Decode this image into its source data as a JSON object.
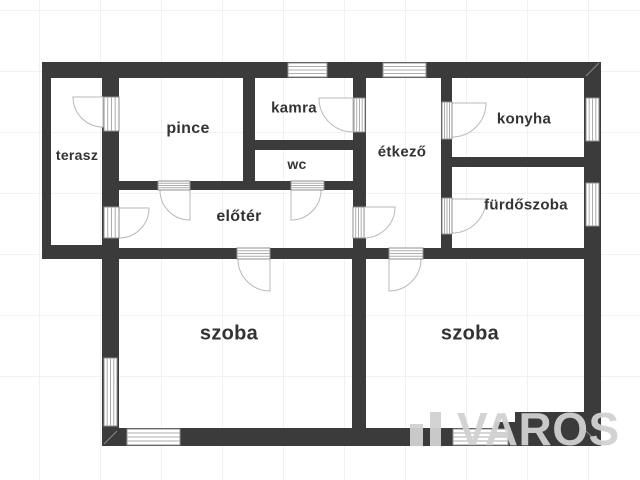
{
  "floor_plan": {
    "title": "floor plan of a house",
    "rooms": [
      {
        "id": "terasz",
        "label": "terasz"
      },
      {
        "id": "pince",
        "label": "pince"
      },
      {
        "id": "kamra",
        "label": "kamra"
      },
      {
        "id": "wc",
        "label": "wc"
      },
      {
        "id": "etkezo",
        "label": "étkező"
      },
      {
        "id": "konyha",
        "label": "konyha"
      },
      {
        "id": "eloter",
        "label": "előtér"
      },
      {
        "id": "furdoszoba",
        "label": "fürdőszoba"
      },
      {
        "id": "szoba-left",
        "label": "szoba"
      },
      {
        "id": "szoba-right",
        "label": "szoba"
      }
    ],
    "watermark": {
      "text": "VAROS"
    },
    "colors": {
      "wall": "#3b3b3c",
      "grid_line": "#f1f1f1",
      "label_text": "#333333",
      "opening_frame": "#8f8f8f",
      "opening_stripe": "#adadad",
      "door_arc": "#b8b8b8",
      "watermark": "#d1d1d1"
    }
  }
}
